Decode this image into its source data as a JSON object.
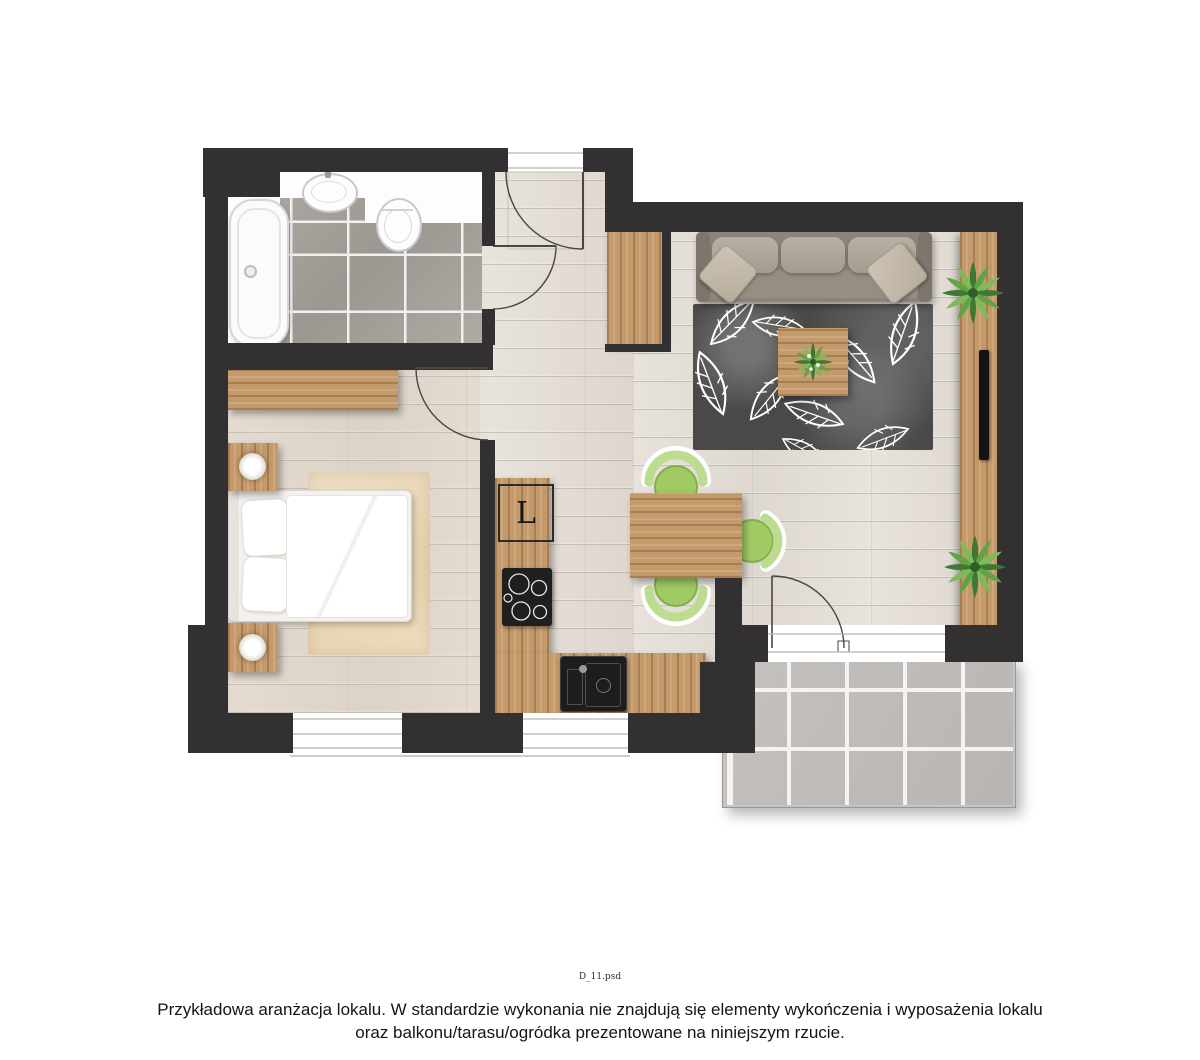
{
  "labels": {
    "fridge": "L",
    "filename": "D_11.psd",
    "caption_line1": "Przykładowa aranżacja lokalu. W standardzie wykonania nie znajdują się elementy wykończenia i wyposażenia lokalu",
    "caption_line2": "oraz balkonu/tarasu/ogródka prezentowane na niniejszym rzucie."
  },
  "colors": {
    "wall": "#333031",
    "floor_plank": "#e4dfd9",
    "wood_furniture": "#c49a6b",
    "bath_tile": "#a7a19c",
    "balcony_tile": "#c0bdba",
    "rug_living": "#4a4948",
    "rug_bedroom": "#e9d6b4",
    "sofa": "#8c847a",
    "chair_green": "#a0ca63",
    "chair_back_green": "#bcdc90",
    "plant_green": "#4e8f3c",
    "appliance_black": "#1f1f1f",
    "door_line": "#4a4645",
    "window_line": "#b9b5b0"
  }
}
